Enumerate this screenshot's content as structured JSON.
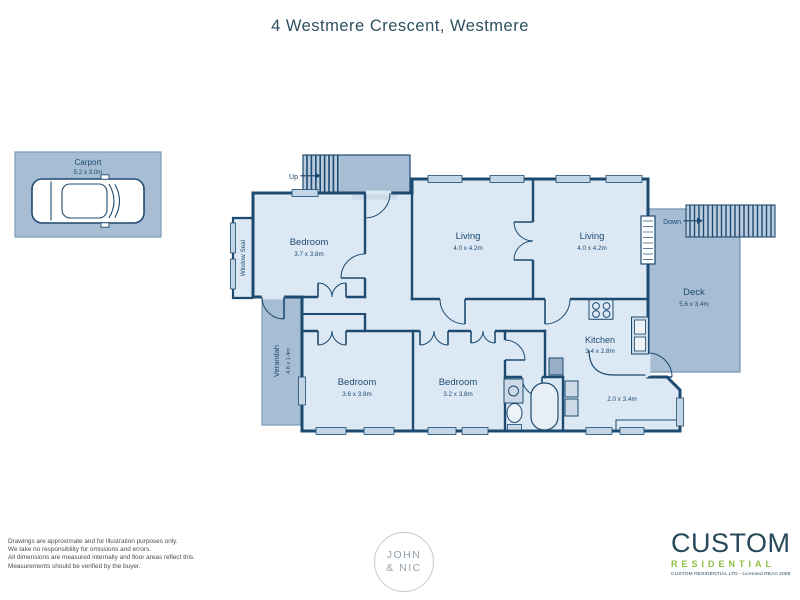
{
  "title": "4 Westmere Crescent, Westmere",
  "plan": {
    "carport": {
      "name": "Carport",
      "dims": "5.2 x 3.0m"
    },
    "rooms": {
      "bedroom1": {
        "name": "Bedroom",
        "dims": "3.7 x 3.8m"
      },
      "living1": {
        "name": "Living",
        "dims": "4.0 x 4.2m"
      },
      "living2": {
        "name": "Living",
        "dims": "4.0 x 4.2m"
      },
      "kitchen": {
        "name": "Kitchen",
        "dims": "3.4 x 2.8m"
      },
      "bedroom2": {
        "name": "Bedroom",
        "dims": "3.6 x 3.8m"
      },
      "bedroom3": {
        "name": "Bedroom",
        "dims": "3.2 x 3.8m"
      },
      "deck": {
        "name": "Deck",
        "dims": "5.6 x 3.4m"
      },
      "verandah": {
        "name": "Verandah",
        "dims": "4.8 x 1.4m"
      },
      "entry": {
        "dims": "2.0 x 3.4m"
      },
      "window_seat": {
        "name": "Window Seat"
      }
    },
    "stairs": {
      "up_label": "Up",
      "down_label": "Down"
    }
  },
  "disclaimer": {
    "line1": "Drawings are approximate and for illustration purposes only.",
    "line2": "We take no responsibility for omissions and errors.",
    "line3": "All dimensions are measured internally and floor areas reflect this.",
    "line4": "Measurements should be verified by the buyer."
  },
  "footer_logos": {
    "john_nic": {
      "line1": "JOHN",
      "line2": "& NIC"
    },
    "custom": {
      "word1": "CUSTOM",
      "word2": "RESIDENTIAL",
      "tagline": "CUSTOM RESIDENTIAL LTD - Licensed REAA 2008"
    }
  },
  "colors": {
    "wall": "#1d4a70",
    "interior": "#dce9f5",
    "outdoor": "#a6bdd3",
    "stair_tread": "#b9cbdd",
    "window": "#c2d6e8",
    "accent_green": "#8cbf40",
    "logo_navy": "#27495a",
    "label_navy": "#1d4a70"
  }
}
